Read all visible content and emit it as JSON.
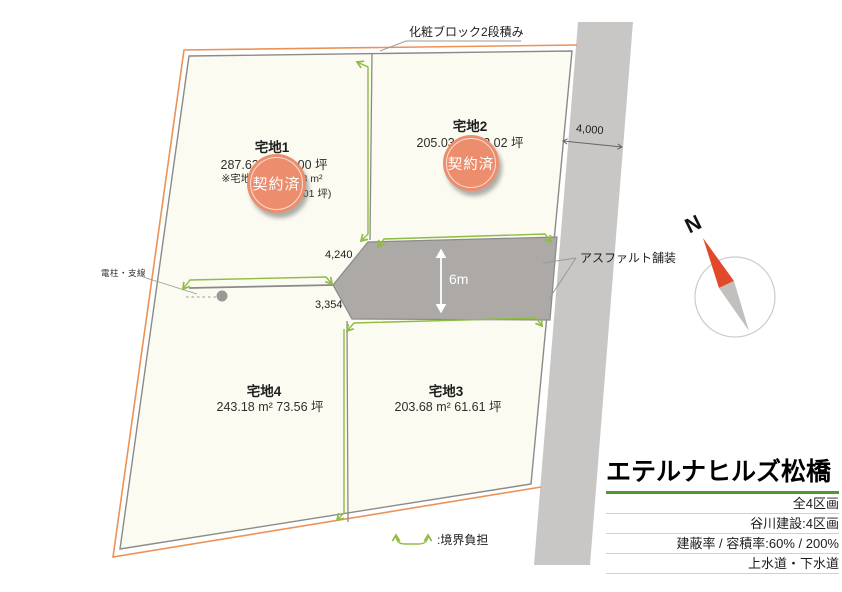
{
  "site": {
    "plots": [
      {
        "name": "宅地1",
        "area": "287.63 m² 87.00 坪",
        "note_line1": "※宅地部分 254.88 m²",
        "note_line2": "(77.01 坪)",
        "badge": "契約済"
      },
      {
        "name": "宅地2",
        "area": "205.03 m² 62.02 坪",
        "badge": "契約済"
      },
      {
        "name": "宅地3",
        "area": "203.68 m² 61.61 坪"
      },
      {
        "name": "宅地4",
        "area": "243.18 m² 73.56 坪"
      }
    ],
    "dimensions": {
      "front_road_width": "4,000",
      "upper_edge": "4,240",
      "lower_edge": "3,354",
      "center_road_width": "6m"
    },
    "labels": {
      "block_wall": "化粧ブロック2段積み",
      "asphalt": "アスファルト舗装",
      "utility_pole": "電柱・支線"
    },
    "compass": {
      "north": "N"
    }
  },
  "legend": {
    "symbol_label": ":境界負担"
  },
  "info_panel": {
    "title": "エテルナヒルズ松橋",
    "rows": [
      "全4区画",
      "谷川建設:4区画",
      "建蔽率 / 容積率:60% / 200%",
      "上水道・下水道"
    ]
  },
  "colors": {
    "boundary_orange": "#EC9257",
    "marker_green": "#8EBC45",
    "badge_salmon": "#EC8E6D",
    "road_dark_gray": "#ADA9A7",
    "road_light_gray": "#C9C7C5",
    "plot_cream": "#FBFBF1",
    "title_underline_green": "#4E9A30",
    "compass_red": "#E2492A"
  }
}
